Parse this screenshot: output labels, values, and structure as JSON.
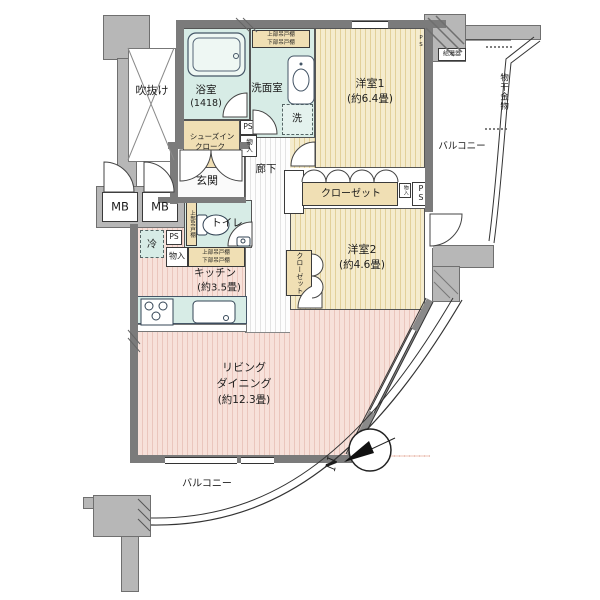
{
  "rooms": {
    "void": "吹抜け",
    "bath": "浴室",
    "bath_size": "(1418)",
    "washroom": "洗面室",
    "washer": "洗",
    "bedroom1": "洋室1",
    "bedroom1_size": "(約6.4畳)",
    "bedroom2": "洋室2",
    "bedroom2_size": "(約4.6畳)",
    "corridor": "廊下",
    "entrance": "玄関",
    "toilet": "トイレ",
    "kitchen": "キッチン",
    "kitchen_size": "(約3.5畳)",
    "living1": "リビング",
    "living2": "ダイニング",
    "living_size": "(約12.3畳)",
    "balcony": "バルコニー",
    "closet": "クローゼット",
    "shoes1": "シューズイン",
    "shoes2": "クローク",
    "laundry": "物干金物",
    "heater": "給湯器"
  },
  "fixtures": {
    "mb": "MB",
    "ps": "PS",
    "fridge": "冷",
    "storage": "物入",
    "cab_upper": "上部吊戸棚",
    "cab_lower": "下部吊戸棚"
  },
  "compass": {
    "north": "N"
  },
  "colors": {
    "wall": "#7b7b7b",
    "structure": "#b7b7b7",
    "wet_room": "#d7ece6",
    "closet_tan": "#f0dfb4",
    "wood_stripe": "#e2d09a",
    "living_stripe": "#eac6bd"
  }
}
